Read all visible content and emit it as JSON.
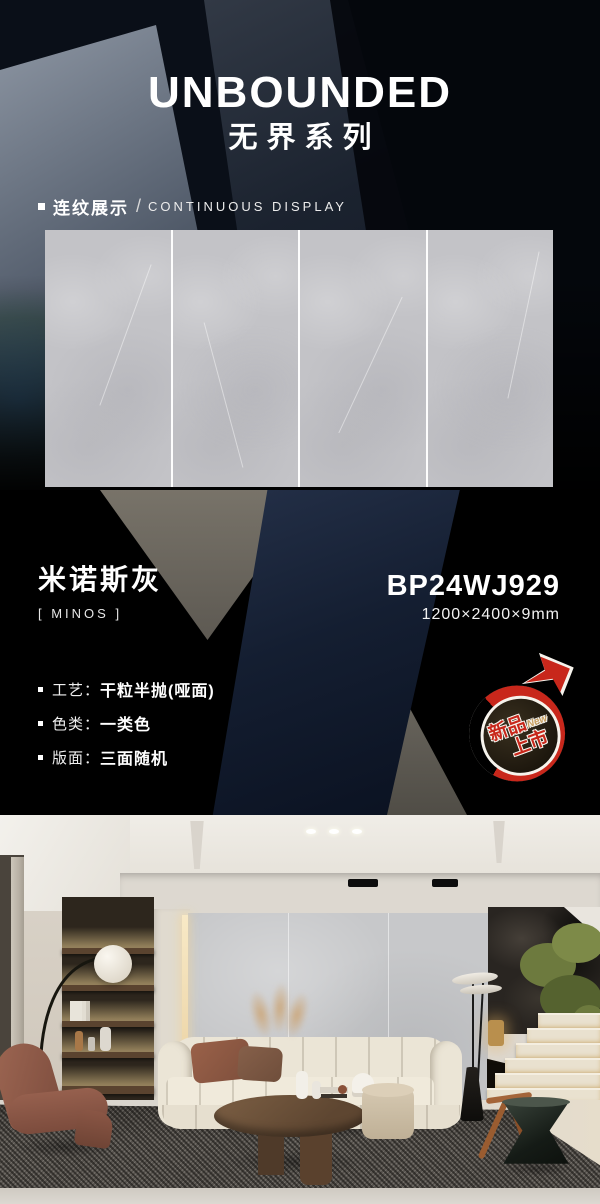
{
  "poster": {
    "series_title_en": "UNBOUNDED",
    "series_title_cn": "无界系列"
  },
  "display_section": {
    "label_cn": "连纹展示",
    "separator": "/",
    "label_en": "CONTINUOUS DISPLAY",
    "panel_count": 4
  },
  "product": {
    "name_cn": "米诺斯灰",
    "name_en_bracketed": "[ MINOS ]",
    "model_code": "BP24WJ929",
    "dimensions": "1200×2400×9mm",
    "specs": [
      {
        "label": "工艺：",
        "value": "干粒半抛(哑面)"
      },
      {
        "label": "色类：",
        "value": "一类色"
      },
      {
        "label": "版面：",
        "value": "三面随机"
      }
    ]
  },
  "new_badge": {
    "word1": "新品",
    "word2": "上市",
    "tag": "New"
  },
  "colors": {
    "background": "#000000",
    "accent_navy": "#16243a",
    "accent_taupe": "#6f6b63",
    "tile_gray": "#c4c4c8",
    "badge_red": "#c8271b",
    "badge_gold": "#c9a062",
    "text_white": "#ffffff"
  }
}
